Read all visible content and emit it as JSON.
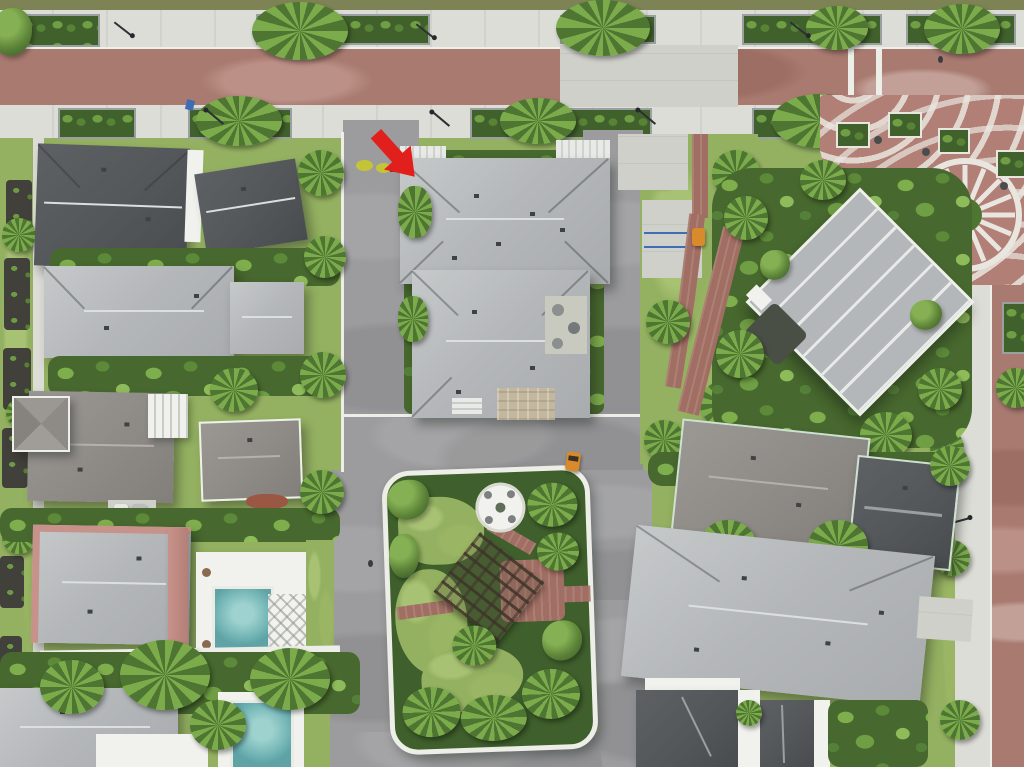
{
  "scene": {
    "description": "Aerial drone photograph of a planned tropical residential neighborhood with brick streets, palm landscaping, a community building, a decorative plaza and a landscaped cul-de-sac island. A red arrow annotation points at the roof of one home.",
    "image_type": "aerial-photograph",
    "annotation": {
      "name": "red-arrow-marker",
      "shape": "thick arrow pointing down-right",
      "color": "#e1201d",
      "target": "northwest roof corner of the center target home"
    },
    "palette": {
      "grassVerge": "#7e8355",
      "sidewalk": "#dcddd7",
      "concretePad": "#cfd0ca",
      "brickRoad": "#a87a70",
      "brickPath": "#a06e62",
      "plazaBrick": "#b17f75",
      "plazaWhite": "#e9e6df",
      "asphalt": "#9c9c9e",
      "lawn": "#94b161",
      "lawnLight": "#a8c274",
      "shrubDark": "#47682e",
      "shrubMid": "#5c8038",
      "palmLight": "#7cab4c",
      "mulch": "#41403a",
      "roofLight": "#b6b9ba",
      "roofRidge": "#dcdfdf",
      "roofMid": "#8f8c88",
      "roofDark": "#54585b",
      "roofPink": "#c6928a",
      "wallWhite": "#f1f2ee",
      "poolTeal": "#74b6b6",
      "curbWhite": "#eceee7",
      "arrowRed": "#e1201d",
      "cartOrange": "#d98a2b",
      "signBlue": "#3d6db5",
      "yellowShrub": "#c3c537"
    },
    "objects": {
      "main_street": {
        "orientation": "horizontal, top of frame",
        "surface": "red brick pavers",
        "features": [
          "concrete sidewalks on both sides",
          "raised hedge planters with street trees",
          "black street lamps",
          "wide concrete crossing",
          "white crosswalk bars"
        ]
      },
      "side_street_right": {
        "orientation": "vertical, right edge",
        "surface": "red brick pavers",
        "features": [
          "white concrete sidewalk",
          "grass verge",
          "street trees"
        ]
      },
      "plaza": {
        "location": "top right",
        "pattern": "red brick with white fan arcs and a wheel/sunburst circle motif",
        "features": [
          "square hedge planters",
          "cafe tables and chairs",
          "central planted tree well",
          "pedestrians"
        ]
      },
      "community_building": {
        "location": "right of center, rotated 45 degrees",
        "roof": "gray standing-seam metal panels with white seams and white parapet"
      },
      "target_home": {
        "location": "top center",
        "roof": "light gray shingle hip roof, two connected wings, white flat roof sections, rear lanai and paver driveway",
        "marked_by": "red arrow annotation"
      },
      "homes": [
        {
          "id": "home-nw-1",
          "roof": "dark charcoal gable"
        },
        {
          "id": "home-nw-2",
          "roof": "dark charcoal, slightly rotated"
        },
        {
          "id": "home-w-1",
          "roof": "light gray hip"
        },
        {
          "id": "home-w-2",
          "roof": "taupe hip with pyramidal corner turret and striped lanai"
        },
        {
          "id": "home-w-3",
          "roof": "taupe hip, red mulch bed"
        },
        {
          "id": "home-w-4",
          "roof": "gray hip with pink tile ridge, rear pool with white deck and lattice pavilion"
        },
        {
          "id": "home-sw",
          "roof": "light gray hip, second pool, palm canopy"
        },
        {
          "id": "home-e-1",
          "roof": "taupe hip with charcoal wing, mint-white trim"
        },
        {
          "id": "home-e-2",
          "roof": "large light gray hip"
        },
        {
          "id": "home-s",
          "roof": "charcoal gables with white walls and palm courtyard"
        }
      ],
      "cul_de_sac_island": {
        "location": "bottom center",
        "features": [
          "white curb ring",
          "circular white seating patio",
          "dark wood pergola",
          "red brick paths",
          "lawn patches",
          "dense tropical planting"
        ]
      },
      "pools": [
        {
          "location": "left of center",
          "color": "#74b6b6"
        },
        {
          "location": "bottom left",
          "color": "#74b6b6"
        }
      ],
      "vehicles_and_people": [
        {
          "type": "golf-cart",
          "color": "#d98a2b",
          "location": "loop road right of island"
        },
        {
          "type": "utility-cart",
          "color": "#d98a2b",
          "location": "brick path east of target home"
        },
        {
          "type": "parked-cars",
          "count": 2,
          "location": "driveway of west block"
        },
        {
          "type": "pedestrian",
          "location": "brick road near plaza"
        },
        {
          "type": "pedestrian",
          "location": "road west of island"
        }
      ],
      "misc": [
        "yellow-green accent shrubs near target home's street corner",
        "blue street signs",
        "dark mulch garden beds along left edge",
        "concrete sport pad with blue lines east of target home"
      ]
    }
  }
}
